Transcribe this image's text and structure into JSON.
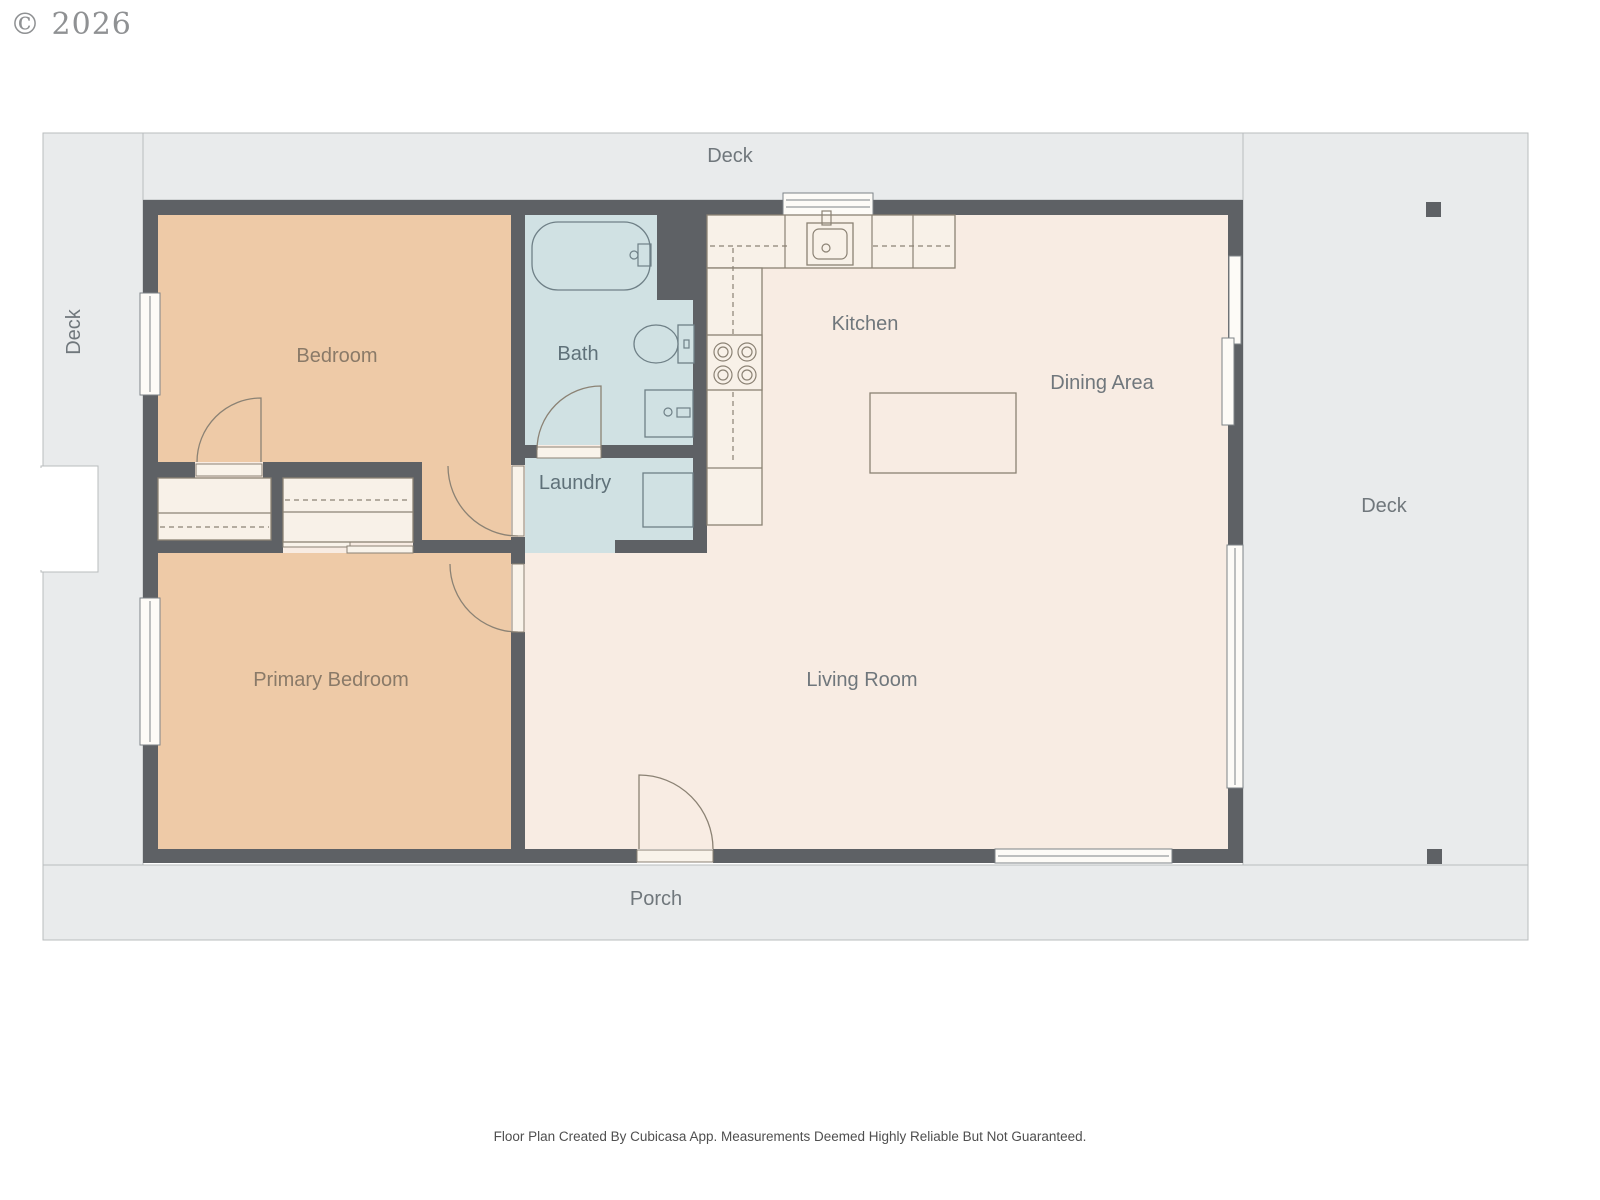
{
  "copyright": "© 2026",
  "outdoor": {
    "deck_top": "Deck",
    "deck_left": "Deck",
    "deck_right": "Deck",
    "porch": "Porch"
  },
  "rooms": {
    "bedroom": "Bedroom",
    "primary_bedroom": "Primary Bedroom",
    "bath": "Bath",
    "laundry": "Laundry",
    "kitchen": "Kitchen",
    "dining": "Dining Area",
    "living": "Living Room"
  },
  "footer": "Floor Plan Created By Cubicasa App. Measurements Deemed Highly Reliable But Not Guaranteed.",
  "colors": {
    "wall": "#5e6165",
    "bedroom_fill": "#eecaa7",
    "wet_room_fill": "#d0e1e3",
    "living_fill": "#f8ece3",
    "outdoor_fill": "#e9ebec",
    "fixture_fill": "#f8f1e8",
    "fixture_line": "#8b8274",
    "label_gray": "#70777c",
    "label_warm": "#8a7a68",
    "label_blue": "#5f7179"
  }
}
